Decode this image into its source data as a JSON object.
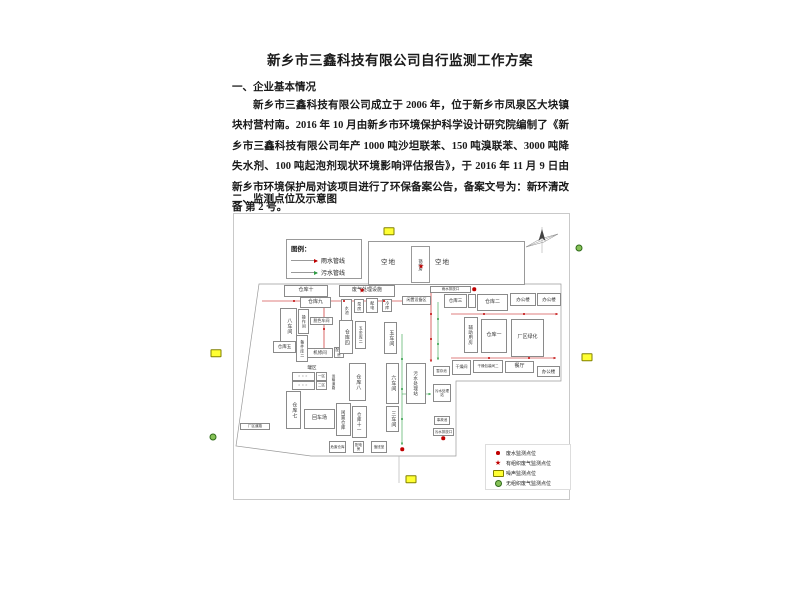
{
  "doc": {
    "title": "新乡市三鑫科技有限公司自行监测工作方案",
    "section1_heading": "一、企业基本情况",
    "paragraph": "新乡市三鑫科技有限公司成立于 2006 年，位于新乡市凤泉区大块镇块村营村南。2016 年 10 月由新乡市环境保护科学设计研究院编制了《新乡市三鑫科技有限公司年产 1000 吨沙坦联苯、150 吨溴联苯、3000 吨降失水剂、100 吨起泡剂现状环境影响评估报告》，于 2016 年 11 月 9 日由新乡市环境保护局对该项目进行了环保备案公告，备案文号为：新环清改备 第 2 号。",
    "section2_heading": "二、监测点位及示意图"
  },
  "colors": {
    "rain_pipe": "#c00000",
    "sewage_pipe": "#2e9e44",
    "noise_marker": "#ffff33",
    "fugitive_marker": "#86c157",
    "boundary": "#9a9a9a"
  },
  "diagram": {
    "legend": {
      "title": "图例：",
      "items": [
        {
          "label": "雨水管线",
          "color": "#c00000"
        },
        {
          "label": "污水管线",
          "color": "#2e9e44"
        }
      ]
    },
    "point_legend": {
      "items": [
        {
          "marker": "red-dot",
          "label": "废水监测点位"
        },
        {
          "marker": "red-star",
          "label": "有组织废气监测点位"
        },
        {
          "marker": "yellow-rect",
          "label": "噪声监测点位"
        },
        {
          "marker": "green-dot",
          "label": "无组织废气监测点位"
        }
      ]
    },
    "open_area": {
      "left_label": "空地",
      "boiler_label": "锅炉房",
      "right_label": "空地"
    },
    "boundary": "25,70 327,70 327,167 222,167 222,242 77,242 2,232",
    "roads": [
      {
        "points": "165,242 165,269"
      }
    ],
    "boxes": [
      {
        "x": 50,
        "y": 71,
        "w": 44,
        "h": 12,
        "label": "仓库十"
      },
      {
        "x": 66,
        "y": 83,
        "w": 31,
        "h": 11,
        "label": "仓库九"
      },
      {
        "x": 46,
        "y": 94,
        "w": 17,
        "h": 37,
        "label": "八车间",
        "v": 1
      },
      {
        "x": 64,
        "y": 95,
        "w": 11,
        "h": 25,
        "label": "操作间",
        "v": 1,
        "fs": 4
      },
      {
        "x": 76,
        "y": 103,
        "w": 23,
        "h": 8,
        "label": "脱色车间",
        "fs": 4
      },
      {
        "x": 62,
        "y": 121,
        "w": 12,
        "h": 27,
        "label": "备件库二",
        "v": 1,
        "fs": 4
      },
      {
        "x": 39,
        "y": 127,
        "w": 23,
        "h": 12,
        "label": "仓库五",
        "fs": 4.5
      },
      {
        "x": 73,
        "y": 134,
        "w": 26,
        "h": 10,
        "label": "机修间",
        "fs": 4.5
      },
      {
        "x": 100,
        "y": 133,
        "w": 10,
        "h": 11,
        "label": "配电房",
        "fs": 3.5
      },
      {
        "x": 105,
        "y": 71,
        "w": 56,
        "h": 12,
        "label": "废气处理设施",
        "fs": 5
      },
      {
        "x": 107,
        "y": 85,
        "w": 11,
        "h": 22,
        "label": "水池",
        "v": 1,
        "fs": 4
      },
      {
        "x": 120,
        "y": 85,
        "w": 10,
        "h": 14,
        "label": "泵房",
        "v": 1,
        "fs": 4
      },
      {
        "x": 132,
        "y": 84,
        "w": 12,
        "h": 15,
        "label": "配电",
        "v": 1,
        "fs": 4
      },
      {
        "x": 148,
        "y": 85,
        "w": 10,
        "h": 13,
        "label": "冷库",
        "v": 1,
        "fs": 4
      },
      {
        "x": 105,
        "y": 106,
        "w": 14,
        "h": 34,
        "label": "仓库四",
        "v": 1
      },
      {
        "x": 121,
        "y": 107,
        "w": 11,
        "h": 28,
        "label": "五金库二",
        "v": 1,
        "fs": 4
      },
      {
        "x": 150,
        "y": 108,
        "w": 13,
        "h": 32,
        "label": "五车间",
        "v": 1
      },
      {
        "x": 168,
        "y": 82,
        "w": 29,
        "h": 9,
        "label": "闲置设备区",
        "fs": 4
      },
      {
        "x": 196,
        "y": 72,
        "w": 41,
        "h": 7,
        "label": "雨水排放口",
        "fs": 3.5
      },
      {
        "x": 210,
        "y": 80,
        "w": 23,
        "h": 14,
        "label": "仓库三",
        "fs": 4.5
      },
      {
        "x": 234,
        "y": 80,
        "w": 8,
        "h": 14,
        "label": "",
        "fs": 4
      },
      {
        "x": 243,
        "y": 80,
        "w": 31,
        "h": 17,
        "label": "仓库二",
        "fs": 5
      },
      {
        "x": 276,
        "y": 79,
        "w": 26,
        "h": 13,
        "label": "办公楼",
        "fs": 4.5
      },
      {
        "x": 303,
        "y": 79,
        "w": 24,
        "h": 13,
        "label": "办公楼",
        "fs": 4.5
      },
      {
        "x": 230,
        "y": 103,
        "w": 14,
        "h": 36,
        "label": "辅助用房",
        "v": 1,
        "fs": 4.5
      },
      {
        "x": 247,
        "y": 105,
        "w": 26,
        "h": 34,
        "label": "仓库一",
        "fs": 5
      },
      {
        "x": 277,
        "y": 105,
        "w": 33,
        "h": 38,
        "label": "厂区绿化",
        "fs": 5
      },
      {
        "x": 218,
        "y": 146,
        "w": 19,
        "h": 15,
        "label": "干燥间",
        "fs": 4
      },
      {
        "x": 239,
        "y": 146,
        "w": 30,
        "h": 13,
        "label": "干燥包装间二",
        "fs": 3.5
      },
      {
        "x": 271,
        "y": 147,
        "w": 29,
        "h": 12,
        "label": "餐厅",
        "fs": 5
      },
      {
        "x": 303,
        "y": 152,
        "w": 23,
        "h": 11,
        "label": "办公楼",
        "fs": 4.5
      },
      {
        "x": 70,
        "y": 150,
        "w": 16,
        "h": 8,
        "label": "罐区",
        "fs": 4.5,
        "nob": 1
      },
      {
        "x": 58,
        "y": 158,
        "w": 23,
        "h": 9,
        "label": "○○○",
        "fs": 3.5,
        "cls": "tank"
      },
      {
        "x": 58,
        "y": 167,
        "w": 23,
        "h": 9,
        "label": "○○○",
        "fs": 3.5,
        "cls": "tank"
      },
      {
        "x": 82,
        "y": 158,
        "w": 11,
        "h": 9,
        "label": "一区",
        "fs": 3.5
      },
      {
        "x": 82,
        "y": 167,
        "w": 11,
        "h": 9,
        "label": "二区",
        "fs": 3.5
      },
      {
        "x": 96,
        "y": 151,
        "w": 8,
        "h": 33,
        "label": "运输道路",
        "v": 1,
        "fs": 3.5,
        "nob": 1
      },
      {
        "x": 115,
        "y": 149,
        "w": 17,
        "h": 38,
        "label": "仓库八",
        "v": 1
      },
      {
        "x": 152,
        "y": 149,
        "w": 13,
        "h": 41,
        "label": "六车间",
        "v": 1
      },
      {
        "x": 172,
        "y": 149,
        "w": 20,
        "h": 41,
        "label": "污水处理站",
        "v": 1,
        "fs": 4.5
      },
      {
        "x": 199,
        "y": 152,
        "w": 17,
        "h": 10,
        "label": "暂存池",
        "fs": 3.5
      },
      {
        "x": 199,
        "y": 170,
        "w": 18,
        "h": 18,
        "label": "污水处理站",
        "fs": 3.5
      },
      {
        "x": 200,
        "y": 202,
        "w": 16,
        "h": 9,
        "label": "事故池",
        "fs": 3.5
      },
      {
        "x": 52,
        "y": 177,
        "w": 15,
        "h": 38,
        "label": "仓库七",
        "v": 1
      },
      {
        "x": 70,
        "y": 195,
        "w": 31,
        "h": 20,
        "label": "回车场",
        "fs": 5
      },
      {
        "x": 102,
        "y": 189,
        "w": 15,
        "h": 33,
        "label": "闲置仓库",
        "v": 1,
        "fs": 4.5
      },
      {
        "x": 118,
        "y": 192,
        "w": 15,
        "h": 32,
        "label": "仓库十一",
        "v": 1,
        "fs": 4.5
      },
      {
        "x": 152,
        "y": 192,
        "w": 13,
        "h": 26,
        "label": "三车间",
        "v": 1
      },
      {
        "x": 6,
        "y": 209,
        "w": 30,
        "h": 7,
        "label": "厂区道路",
        "fs": 3.5
      },
      {
        "x": 95,
        "y": 227,
        "w": 17,
        "h": 12,
        "label": "危废仓库",
        "fs": 3.5
      },
      {
        "x": 119,
        "y": 227,
        "w": 11,
        "h": 12,
        "label": "配电房",
        "fs": 3.5
      },
      {
        "x": 137,
        "y": 227,
        "w": 16,
        "h": 12,
        "label": "值班室",
        "fs": 3.5
      },
      {
        "x": 199,
        "y": 214,
        "w": 21,
        "h": 8,
        "label": "污水排放口",
        "fs": 3.5
      }
    ],
    "pipes": [
      {
        "x1": 28,
        "y1": 87,
        "x2": 196,
        "y2": 87,
        "c": "r"
      },
      {
        "x1": 90,
        "y1": 92,
        "x2": 90,
        "y2": 142,
        "c": "r"
      },
      {
        "x1": 197,
        "y1": 79,
        "x2": 197,
        "y2": 148,
        "c": "r"
      },
      {
        "x1": 217,
        "y1": 100,
        "x2": 324,
        "y2": 100,
        "c": "r"
      },
      {
        "x1": 217,
        "y1": 144,
        "x2": 322,
        "y2": 144,
        "c": "r"
      },
      {
        "x1": 204,
        "y1": 88,
        "x2": 204,
        "y2": 146,
        "c": "g"
      },
      {
        "x1": 168,
        "y1": 120,
        "x2": 168,
        "y2": 231,
        "c": "g"
      },
      {
        "x1": 168,
        "y1": 180,
        "x2": 197,
        "y2": 180,
        "c": "g"
      }
    ],
    "markers": [
      {
        "t": "yrect",
        "x": 155,
        "y": 17,
        "name": "noise-point-north"
      },
      {
        "t": "yrect",
        "x": -18,
        "y": 139,
        "name": "noise-point-west"
      },
      {
        "t": "yrect",
        "x": 353,
        "y": 143,
        "name": "noise-point-east"
      },
      {
        "t": "yrect",
        "x": 177,
        "y": 265,
        "name": "noise-point-south"
      },
      {
        "t": "gdot",
        "x": 345,
        "y": 34,
        "name": "fugitive-gas-point-ne"
      },
      {
        "t": "gdot",
        "x": -21,
        "y": 223,
        "name": "fugitive-gas-point-sw"
      },
      {
        "t": "star",
        "x": 187,
        "y": 53,
        "name": "organized-gas-point-boiler"
      },
      {
        "t": "star",
        "x": 128,
        "y": 77,
        "name": "organized-gas-point-treatment"
      },
      {
        "t": "dot",
        "x": 240,
        "y": 75,
        "name": "wastewater-point-outlet-north"
      },
      {
        "t": "dot",
        "x": 209,
        "y": 224,
        "name": "wastewater-point-outlet-south"
      },
      {
        "t": "dot",
        "x": 168,
        "y": 235,
        "name": "wastewater-point-main"
      },
      {
        "t": "pdot",
        "x": 60,
        "y": 87
      },
      {
        "t": "pdot",
        "x": 110,
        "y": 87
      },
      {
        "t": "pdot",
        "x": 150,
        "y": 87
      },
      {
        "t": "pdot",
        "x": 90,
        "y": 115
      },
      {
        "t": "pdot",
        "x": 197,
        "y": 100
      },
      {
        "t": "pdot",
        "x": 197,
        "y": 125
      },
      {
        "t": "pdot",
        "x": 250,
        "y": 100
      },
      {
        "t": "pdot",
        "x": 290,
        "y": 100
      },
      {
        "t": "pdot",
        "x": 255,
        "y": 144
      },
      {
        "t": "pdot",
        "x": 295,
        "y": 144
      },
      {
        "t": "pgdot",
        "x": 204,
        "y": 105
      },
      {
        "t": "pgdot",
        "x": 204,
        "y": 130
      },
      {
        "t": "pgdot",
        "x": 168,
        "y": 145
      },
      {
        "t": "pgdot",
        "x": 168,
        "y": 175
      },
      {
        "t": "pgdot",
        "x": 168,
        "y": 205
      }
    ]
  }
}
